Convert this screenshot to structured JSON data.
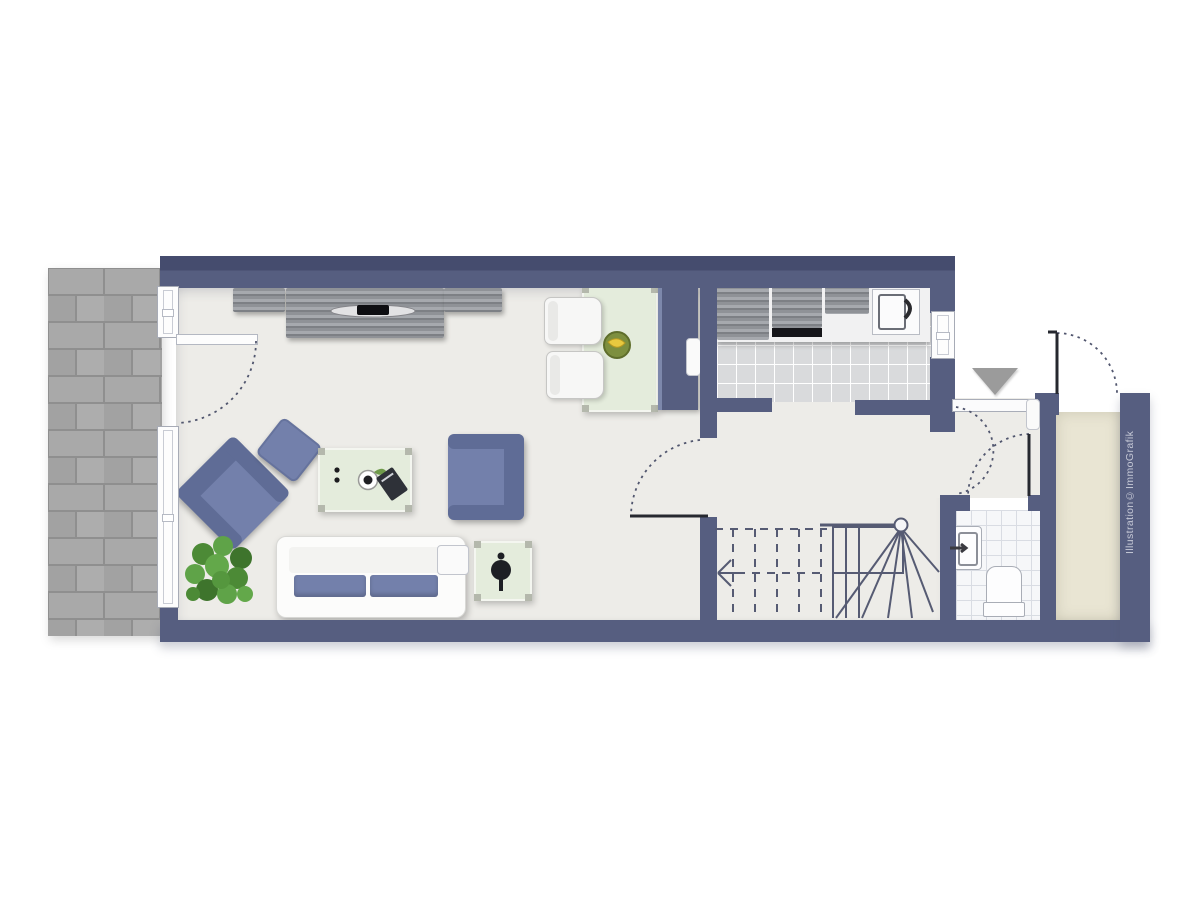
{
  "watermark": {
    "text": "Illustration©ImmoGrafik"
  },
  "colors": {
    "wall": "#565e80",
    "wall_deep": "#454c6e",
    "floor": "#edece8",
    "kitchen_tile": "#d9dadc",
    "wc_tile": "#f6f7f9",
    "porch_floor": "#e9e5d3",
    "terrace_paver": "#a9a9a9",
    "terrace_joint": "#8f8f8f",
    "furniture_blue": "#7380ab",
    "furniture_blue_dark": "#5f6c96",
    "table_green": "#e4ecdc",
    "cabinet_gray": "#8f9297",
    "door_arc": "#51566e",
    "entrance_marker": "#9b9b9b"
  },
  "rooms": [
    {
      "name": "living-dining-room"
    },
    {
      "name": "kitchen"
    },
    {
      "name": "hallway-with-stairs"
    },
    {
      "name": "wc"
    },
    {
      "name": "entrance-porch"
    },
    {
      "name": "terrace"
    }
  ],
  "furniture": [
    "tv-sideboard",
    "dining-table",
    "dining-chairs",
    "fruit-bowl",
    "tall-cabinet",
    "corner-armchair",
    "ottoman",
    "coffee-table",
    "armchair",
    "sofa",
    "side-table",
    "plant",
    "kitchen-counter",
    "fridge",
    "stove",
    "sink",
    "wc-sink",
    "toilet",
    "winder-staircase"
  ]
}
